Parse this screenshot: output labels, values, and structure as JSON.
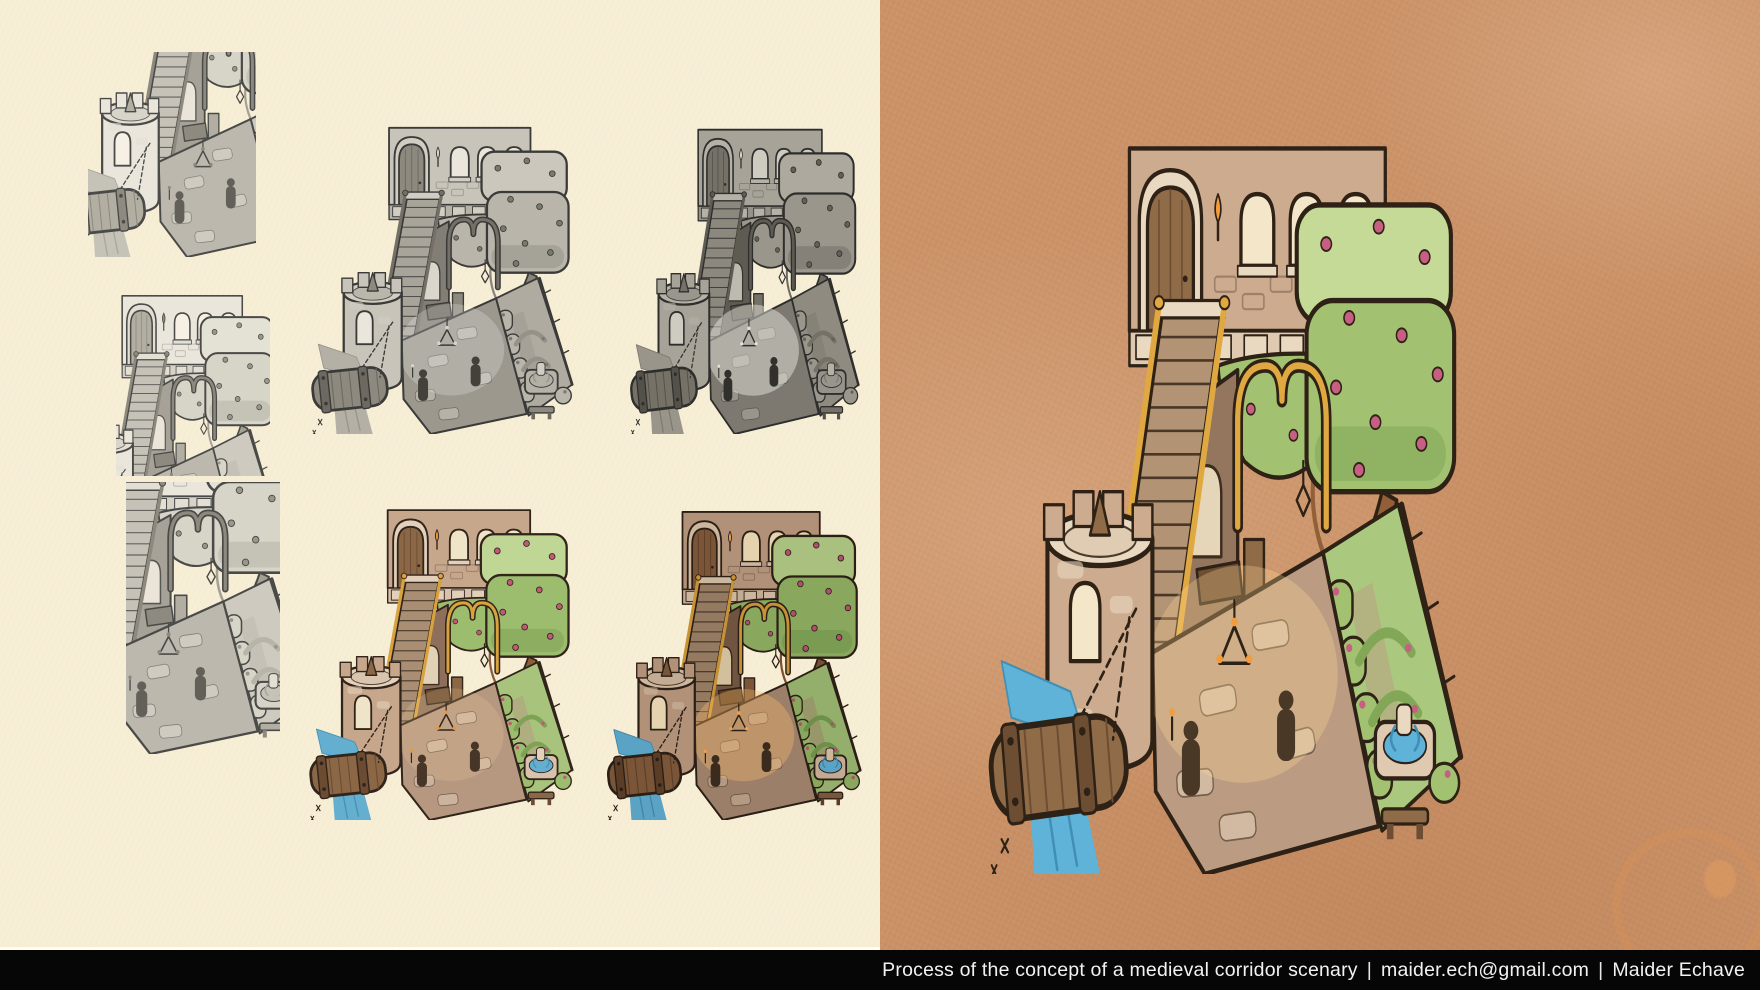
{
  "caption": {
    "title": "Process of the concept of a medieval corridor scenary",
    "separator": "|",
    "email": "maider.ech@gmail.com",
    "author": "Maider Echave"
  },
  "canvas": {
    "width": 1760,
    "height": 990
  },
  "colors": {
    "left_background": "#f7eed6",
    "right_background": "#cb9267",
    "caption_bar": "#060606",
    "caption_text": "#f2f2f2",
    "stain": "#d69258"
  },
  "panels": [
    {
      "id": "sketch-1",
      "name": "thumbnail-sketch-1",
      "stage": "Rough sketch - tower and drawbridge view",
      "palette": "sketch",
      "box": {
        "left": 88,
        "top": 52,
        "width": 168,
        "height": 205
      },
      "viewBox": "30 140 190 220"
    },
    {
      "id": "sketch-2",
      "name": "thumbnail-sketch-2",
      "stage": "Rough sketch - staircase and rose tree view",
      "palette": "sketch",
      "box": {
        "left": 116,
        "top": 286,
        "width": 154,
        "height": 190
      },
      "viewBox": "88 14 200 232"
    },
    {
      "id": "sketch-3",
      "name": "thumbnail-sketch-3",
      "stage": "Rough sketch - arch and fountain view",
      "palette": "sketch",
      "box": {
        "left": 126,
        "top": 482,
        "width": 154,
        "height": 272
      },
      "viewBox": "118 96 152 264"
    },
    {
      "id": "value-study",
      "name": "grayscale-value-study",
      "stage": "Grayscale value study",
      "palette": "value",
      "box": {
        "left": 302,
        "top": 104,
        "width": 272,
        "height": 330
      },
      "viewBox": "0 0 300 360"
    },
    {
      "id": "lighting-study",
      "name": "grayscale-lighting-study",
      "stage": "Grayscale lighting study",
      "palette": "lit",
      "box": {
        "left": 622,
        "top": 106,
        "width": 238,
        "height": 328
      },
      "viewBox": "0 0 300 360"
    },
    {
      "id": "color-study",
      "name": "color-study-flat",
      "stage": "Flat color study",
      "palette": "colorFlat",
      "box": {
        "left": 300,
        "top": 486,
        "width": 274,
        "height": 334
      },
      "viewBox": "0 0 300 360"
    },
    {
      "id": "color-lighting",
      "name": "color-lighting-study",
      "stage": "Color and lighting study",
      "palette": "colorLit",
      "box": {
        "left": 598,
        "top": 488,
        "width": 264,
        "height": 332
      },
      "viewBox": "0 0 300 360"
    },
    {
      "id": "final",
      "name": "final-illustration",
      "stage": "Final colored illustration of the medieval corridor",
      "palette": "final",
      "box": {
        "left": 972,
        "top": 92,
        "width": 492,
        "height": 782
      },
      "viewBox": "0 0 300 360"
    }
  ],
  "palettes": {
    "sketch": {
      "line": "#4a4a48",
      "wall": "#eae6dc",
      "stone": "#d7d3c8",
      "stoneL": "#e3dfd4",
      "wood": "#b2aea2",
      "woodD": "#8e8a7f",
      "stair": "#c6c2b7",
      "floor": "#bcb8ad",
      "inner": "#a6a297",
      "grass": "#cecabf",
      "leaf": "#d7d4c8",
      "leafL": "#e4e1d5",
      "leafD": "#b7b4a8",
      "trunk": "#a4a095",
      "water": "#c5c2b7",
      "waterD": "#a9a69b",
      "rose": "#9a968b",
      "gold": "#8d897e",
      "dark": "#626058",
      "flame": "#8d897e",
      "window": "#f6f1e4",
      "glow": "rgba(255,255,255,0)"
    },
    "value": {
      "line": "#3a3a38",
      "wall": "#c8c4ba",
      "stone": "#b6b2a8",
      "stoneL": "#d1cdc2",
      "wood": "#8d897e",
      "woodD": "#6d6960",
      "stair": "#a8a49a",
      "floor": "#9c988e",
      "inner": "#827e75",
      "grass": "#afaba1",
      "leaf": "#b9b5ab",
      "leafL": "#cbc7bd",
      "leafD": "#969289",
      "trunk": "#89857c",
      "water": "#b4b0a6",
      "waterD": "#99958b",
      "rose": "#7c786f",
      "gold": "#747067",
      "dark": "#44413b",
      "flame": "#d8d4c9",
      "window": "#eae6db",
      "glow": "rgba(255,255,255,0.22)"
    },
    "lit": {
      "line": "#2e2e2c",
      "wall": "#a7a399",
      "stone": "#969289",
      "stoneL": "#b5b1a7",
      "wood": "#757167",
      "woodD": "#545149",
      "stair": "#8c887e",
      "floor": "#7d7970",
      "inner": "#5e5b53",
      "grass": "#8f8b81",
      "leaf": "#9a968c",
      "leafL": "#ada99f",
      "leafD": "#757167",
      "trunk": "#6d6960",
      "water": "#99958b",
      "waterD": "#7d7970",
      "rose": "#655f56",
      "gold": "#5e5b53",
      "dark": "#32302b",
      "flame": "#e6e2d7",
      "window": "#cecbc1",
      "glow": "rgba(242,239,230,0.45)"
    },
    "colorFlat": {
      "line": "#31241a",
      "wall": "#c7a78c",
      "stone": "#d8c2ab",
      "stoneL": "#e2d0bb",
      "wood": "#8b6746",
      "woodD": "#6b4c33",
      "stair": "#a98e74",
      "floor": "#b69780",
      "inner": "#8d6f5b",
      "grass": "#a8c47c",
      "leaf": "#9dbd6e",
      "leafL": "#c0d694",
      "leafD": "#7fa355",
      "trunk": "#8c5f3a",
      "water": "#64aed0",
      "waterD": "#4992b4",
      "rose": "#c2597b",
      "gold": "#d8a23e",
      "dark": "#473627",
      "flame": "#e8953f",
      "window": "#f0e4c8",
      "glow": "rgba(255,220,160,0.18)"
    },
    "colorLit": {
      "line": "#2a1e15",
      "wall": "#b19178",
      "stone": "#c2ab92",
      "stoneL": "#ccb69d",
      "wood": "#7a5537",
      "woodD": "#5a3d26",
      "stair": "#947a60",
      "floor": "#9c7f69",
      "inner": "#6f5440",
      "grass": "#93af6b",
      "leaf": "#89a85e",
      "leafL": "#a9c07f",
      "leafD": "#6d9048",
      "trunk": "#7a4f30",
      "water": "#5aa3c5",
      "waterD": "#4184a5",
      "rose": "#b04e70",
      "gold": "#c79236",
      "dark": "#3a2b1e",
      "flame": "#f0a045",
      "window": "#e4d3ae",
      "glow": "rgba(255,190,110,0.35)"
    },
    "final": {
      "line": "#2e2115",
      "wall": "#cdab8e",
      "stone": "#dfc9b1",
      "stoneL": "#ead9c1",
      "wood": "#906b48",
      "woodD": "#6e4e33",
      "stair": "#b29374",
      "floor": "#bb9c83",
      "inner": "#94755e",
      "grass": "#aac87e",
      "leaf": "#a2c271",
      "leafL": "#c6da97",
      "leafD": "#82a757",
      "trunk": "#935f38",
      "water": "#5fb2d8",
      "waterD": "#418fb5",
      "rose": "#c75f82",
      "gold": "#e0a840",
      "dark": "#4a3827",
      "flame": "#f29c3e",
      "window": "#f4e7c9",
      "glow": "rgba(255,215,150,0.3)"
    }
  }
}
